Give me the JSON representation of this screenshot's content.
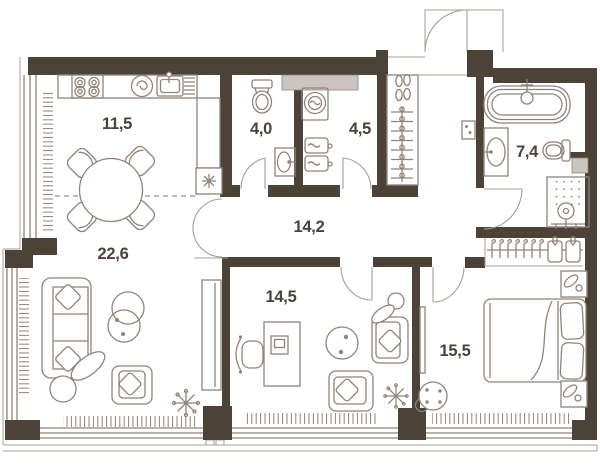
{
  "plan": {
    "type": "apartment-floor-plan",
    "rooms": [
      {
        "name": "kitchen-dining",
        "area": "11,5"
      },
      {
        "name": "living-room",
        "area": "22,6"
      },
      {
        "name": "wc",
        "area": "4,0"
      },
      {
        "name": "bathroom-laundry",
        "area": "4,5"
      },
      {
        "name": "hallway",
        "area": "14,2"
      },
      {
        "name": "bathroom",
        "area": "7,4"
      },
      {
        "name": "study",
        "area": "14,5"
      },
      {
        "name": "bedroom",
        "area": "15,5"
      }
    ],
    "colors": {
      "wall": "#4d4237",
      "line": "#8f8479",
      "line_soft": "#a79d91",
      "fill_gray": "#cac5be",
      "text": "#4a423c",
      "bg": "#ffffff"
    },
    "fixtures": [
      "stove-icon",
      "cooker-hood-icon",
      "kitchen-sink-icon",
      "fridge-icon",
      "dining-table",
      "dining-chair",
      "window",
      "radiator",
      "sofa",
      "plant-icon",
      "nesting-tables",
      "armchair",
      "wardrobe",
      "toilet-icon",
      "washbasin-icon",
      "washing-machine-icon",
      "towel-shelf",
      "entry-wardrobe",
      "hanger-icon",
      "shoe-shelf",
      "entry-door",
      "interior-door",
      "electrical-panel-icon",
      "bathtub-icon",
      "shower-icon",
      "desk",
      "desk-chair",
      "laptop-icon",
      "coffee-table",
      "bed",
      "nightstand",
      "shirt-hanger-icon",
      "pouf",
      "mirror"
    ]
  }
}
